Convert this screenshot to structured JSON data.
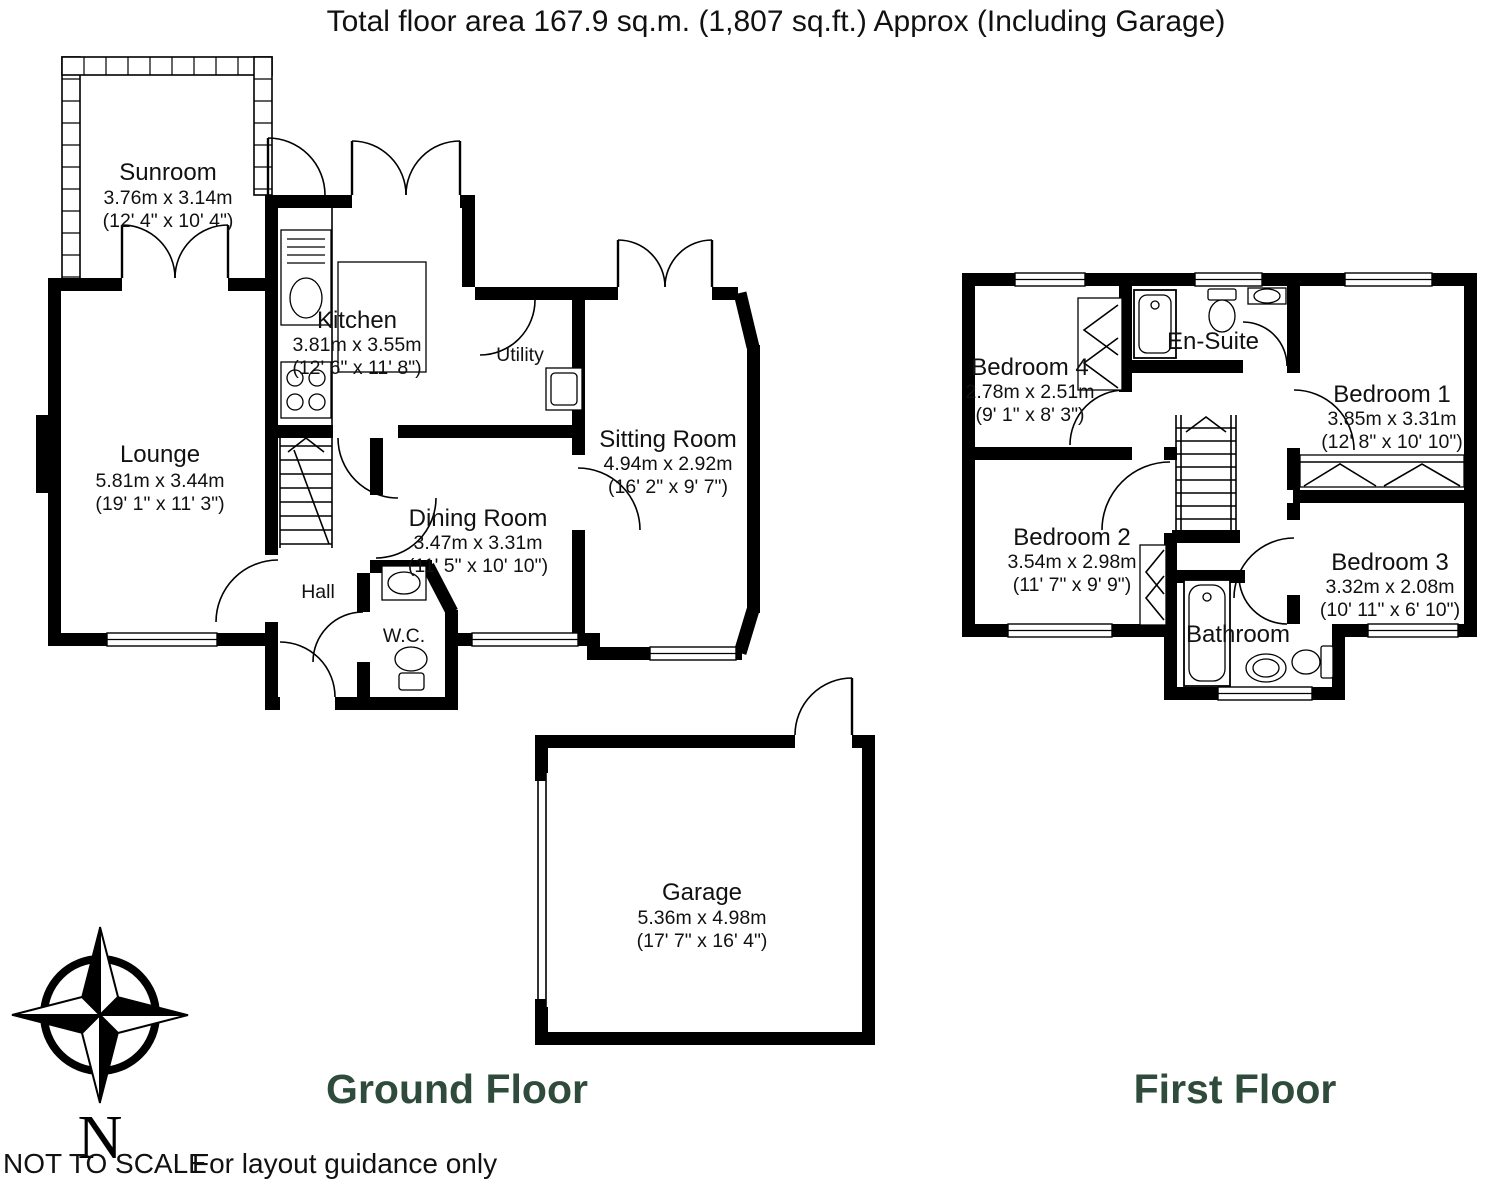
{
  "title": "Total floor area 167.9 sq.m. (1,807 sq.ft.) Approx (Including Garage)",
  "colors": {
    "floor_label": "#2e4b3c",
    "walls": "#000000",
    "background": "#ffffff"
  },
  "ground_floor": {
    "label": "Ground Floor",
    "rooms": {
      "sunroom": {
        "name": "Sunroom",
        "metric": "3.76m x 3.14m",
        "imperial": "(12' 4\" x 10' 4\")"
      },
      "kitchen": {
        "name": "Kitchen",
        "metric": "3.81m x 3.55m",
        "imperial": "(12' 6\" x 11' 8\")"
      },
      "utility": {
        "name": "Utility"
      },
      "sitting_room": {
        "name": "Sitting Room",
        "metric": "4.94m x 2.92m",
        "imperial": "(16' 2\" x 9' 7\")"
      },
      "lounge": {
        "name": "Lounge",
        "metric": "5.81m x 3.44m",
        "imperial": "(19' 1\" x 11' 3\")"
      },
      "dining_room": {
        "name": "Dining Room",
        "metric": "3.47m x 3.31m",
        "imperial": "(11' 5\" x 10' 10\")"
      },
      "hall": {
        "name": "Hall"
      },
      "wc": {
        "name": "W.C."
      },
      "garage": {
        "name": "Garage",
        "metric": "5.36m x 4.98m",
        "imperial": "(17' 7\" x 16' 4\")"
      }
    }
  },
  "first_floor": {
    "label": "First Floor",
    "rooms": {
      "bedroom4": {
        "name": "Bedroom 4",
        "metric": "2.78m x 2.51m",
        "imperial": "(9' 1\" x 8' 3\")"
      },
      "ensuite": {
        "name": "En-Suite"
      },
      "bedroom1": {
        "name": "Bedroom 1",
        "metric": "3.85m x 3.31m",
        "imperial": "(12' 8\" x 10' 10\")"
      },
      "bedroom2": {
        "name": "Bedroom 2",
        "metric": "3.54m x 2.98m",
        "imperial": "(11' 7\" x 9' 9\")"
      },
      "bedroom3": {
        "name": "Bedroom 3",
        "metric": "3.32m x 2.08m",
        "imperial": "(10' 11\" x 6' 10\")"
      },
      "bathroom": {
        "name": "Bathroom"
      }
    }
  },
  "compass": {
    "north_label": "N"
  },
  "footer": {
    "scale_note": "NOT TO SCALE",
    "guidance_note": "For layout guidance only"
  }
}
